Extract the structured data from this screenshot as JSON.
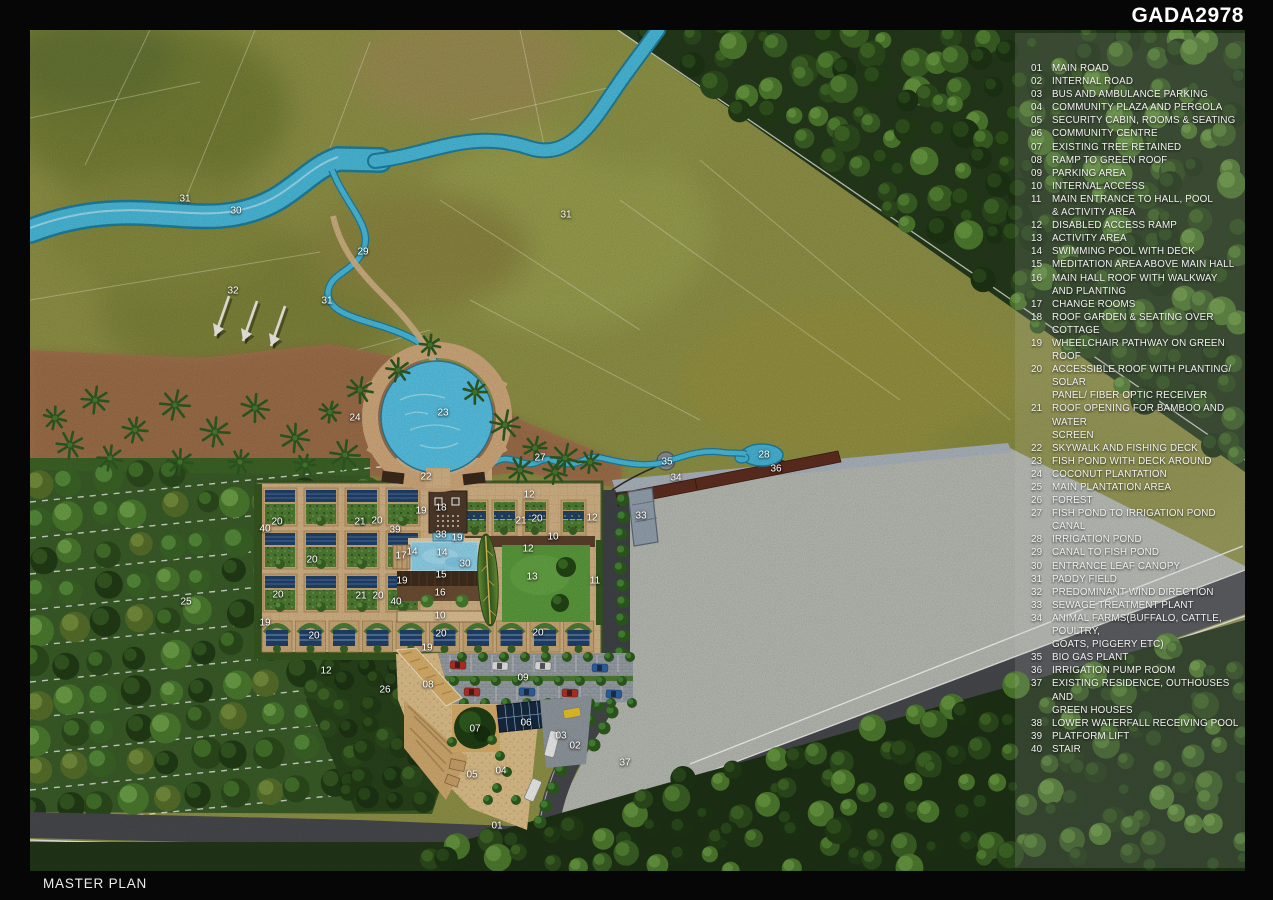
{
  "title": "GADA2978",
  "footer": "MASTER PLAN",
  "colors": {
    "frame": "#060606",
    "paddy": "#8e9146",
    "forest": "#24391b",
    "river": "#49b9d9",
    "deck_tan": "#d3b386",
    "road": "#46484c",
    "open_gray": "#b6bab2",
    "solar_panel": "#20406a",
    "lawn": "#5a9a3c",
    "pond": "#46b4d6",
    "animal_farm_strip": "#5e2d20",
    "label_text": "#ffffff"
  },
  "legend": {
    "items": [
      {
        "no": "01",
        "lines": [
          "MAIN ROAD"
        ]
      },
      {
        "no": "02",
        "lines": [
          "INTERNAL ROAD"
        ]
      },
      {
        "no": "03",
        "lines": [
          "BUS AND AMBULANCE PARKING"
        ]
      },
      {
        "no": "04",
        "lines": [
          "COMMUNITY PLAZA AND PERGOLA"
        ]
      },
      {
        "no": "05",
        "lines": [
          "SECURITY CABIN, ROOMS & SEATING"
        ]
      },
      {
        "no": "06",
        "lines": [
          "COMMUNITY CENTRE"
        ]
      },
      {
        "no": "07",
        "lines": [
          "EXISTING TREE RETAINED"
        ]
      },
      {
        "no": "08",
        "lines": [
          "RAMP TO GREEN ROOF"
        ]
      },
      {
        "no": "09",
        "lines": [
          "PARKING AREA"
        ]
      },
      {
        "no": "10",
        "lines": [
          "INTERNAL ACCESS"
        ]
      },
      {
        "no": "11",
        "lines": [
          "MAIN ENTRANCE TO HALL, POOL",
          "& ACTIVITY AREA"
        ]
      },
      {
        "no": "12",
        "lines": [
          "DISABLED ACCESS RAMP"
        ]
      },
      {
        "no": "13",
        "lines": [
          "ACTIVITY AREA"
        ]
      },
      {
        "no": "14",
        "lines": [
          "SWIMMING POOL WITH DECK"
        ]
      },
      {
        "no": "15",
        "lines": [
          "MEDITATION AREA  ABOVE MAIN HALL"
        ]
      },
      {
        "no": "16",
        "lines": [
          "MAIN HALL ROOF WITH WALKWAY",
          "AND PLANTING"
        ]
      },
      {
        "no": "17",
        "lines": [
          "CHANGE ROOMS"
        ]
      },
      {
        "no": "18",
        "lines": [
          "ROOF GARDEN & SEATING OVER COTTAGE"
        ]
      },
      {
        "no": "19",
        "lines": [
          "WHEELCHAIR PATHWAY ON GREEN ROOF"
        ]
      },
      {
        "no": "20",
        "lines": [
          "ACCESSIBLE ROOF WITH PLANTING/ SOLAR",
          "PANEL/ FIBER OPTIC RECEIVER"
        ]
      },
      {
        "no": "21",
        "lines": [
          "ROOF OPENING FOR BAMBOO AND WATER",
          "SCREEN"
        ]
      },
      {
        "no": "22",
        "lines": [
          "SKYWALK AND FISHING DECK"
        ]
      },
      {
        "no": "23",
        "lines": [
          "FISH POND WITH DECK AROUND"
        ]
      },
      {
        "no": "24",
        "lines": [
          "COCONUT PLANTATION"
        ]
      },
      {
        "no": "25",
        "lines": [
          "MAIN PLANTATION AREA"
        ]
      },
      {
        "no": "26",
        "lines": [
          "FOREST"
        ]
      },
      {
        "no": "27",
        "lines": [
          "FISH POND TO IRRIGATION POND CANAL"
        ]
      },
      {
        "no": "28",
        "lines": [
          "IRRIGATION POND"
        ]
      },
      {
        "no": "29",
        "lines": [
          "CANAL TO FISH POND"
        ]
      },
      {
        "no": "30",
        "lines": [
          "ENTRANCE LEAF CANOPY"
        ]
      },
      {
        "no": "31",
        "lines": [
          "PADDY FIELD"
        ]
      },
      {
        "no": "32",
        "lines": [
          "PREDOMINANT WIND DIRECTION"
        ]
      },
      {
        "no": "33",
        "lines": [
          "SEWAGE TREATMENT PLANT"
        ]
      },
      {
        "no": "34",
        "lines": [
          "ANIMAL FARMS(BUFFALO, CATTLE, POULTRY,",
          "GOATS, PIGGERY ETC)"
        ]
      },
      {
        "no": "35",
        "lines": [
          "BIO GAS PLANT"
        ]
      },
      {
        "no": "36",
        "lines": [
          "IRRIGATION PUMP ROOM"
        ]
      },
      {
        "no": "37",
        "lines": [
          "EXISTING RESIDENCE, OUTHOUSES AND",
          "GREEN HOUSES"
        ]
      },
      {
        "no": "38",
        "lines": [
          "LOWER WATERFALL RECEIVING POOL"
        ]
      },
      {
        "no": "39",
        "lines": [
          "PLATFORM LIFT"
        ]
      },
      {
        "no": "40",
        "lines": [
          "STAIR"
        ]
      }
    ]
  },
  "map_labels": [
    {
      "n": "31",
      "x": 185,
      "y": 199
    },
    {
      "n": "30",
      "x": 236,
      "y": 211
    },
    {
      "n": "29",
      "x": 363,
      "y": 252
    },
    {
      "n": "32",
      "x": 233,
      "y": 291
    },
    {
      "n": "31",
      "x": 327,
      "y": 301
    },
    {
      "n": "31",
      "x": 566,
      "y": 215
    },
    {
      "n": "24",
      "x": 355,
      "y": 418
    },
    {
      "n": "23",
      "x": 443,
      "y": 413
    },
    {
      "n": "22",
      "x": 426,
      "y": 477
    },
    {
      "n": "27",
      "x": 540,
      "y": 458
    },
    {
      "n": "35",
      "x": 667,
      "y": 462
    },
    {
      "n": "28",
      "x": 764,
      "y": 455
    },
    {
      "n": "36",
      "x": 776,
      "y": 469
    },
    {
      "n": "34",
      "x": 676,
      "y": 478
    },
    {
      "n": "33",
      "x": 641,
      "y": 516
    },
    {
      "n": "25",
      "x": 186,
      "y": 602
    },
    {
      "n": "26",
      "x": 385,
      "y": 690
    },
    {
      "n": "40",
      "x": 265,
      "y": 529
    },
    {
      "n": "20",
      "x": 277,
      "y": 522
    },
    {
      "n": "21",
      "x": 360,
      "y": 522
    },
    {
      "n": "20",
      "x": 377,
      "y": 521
    },
    {
      "n": "39",
      "x": 395,
      "y": 530
    },
    {
      "n": "19",
      "x": 421,
      "y": 511
    },
    {
      "n": "18",
      "x": 441,
      "y": 508
    },
    {
      "n": "12",
      "x": 529,
      "y": 495
    },
    {
      "n": "21",
      "x": 521,
      "y": 521
    },
    {
      "n": "20",
      "x": 537,
      "y": 519
    },
    {
      "n": "12",
      "x": 592,
      "y": 518
    },
    {
      "n": "10",
      "x": 553,
      "y": 537
    },
    {
      "n": "12",
      "x": 528,
      "y": 549
    },
    {
      "n": "38",
      "x": 441,
      "y": 535
    },
    {
      "n": "19",
      "x": 457,
      "y": 538
    },
    {
      "n": "14",
      "x": 412,
      "y": 552
    },
    {
      "n": "14",
      "x": 442,
      "y": 553
    },
    {
      "n": "17",
      "x": 401,
      "y": 556
    },
    {
      "n": "15",
      "x": 441,
      "y": 575
    },
    {
      "n": "19",
      "x": 402,
      "y": 581
    },
    {
      "n": "30",
      "x": 465,
      "y": 564
    },
    {
      "n": "13",
      "x": 532,
      "y": 577
    },
    {
      "n": "11",
      "x": 595,
      "y": 581
    },
    {
      "n": "16",
      "x": 440,
      "y": 593
    },
    {
      "n": "40",
      "x": 396,
      "y": 602
    },
    {
      "n": "10",
      "x": 440,
      "y": 616
    },
    {
      "n": "20",
      "x": 312,
      "y": 560
    },
    {
      "n": "20",
      "x": 278,
      "y": 595
    },
    {
      "n": "21",
      "x": 361,
      "y": 596
    },
    {
      "n": "20",
      "x": 378,
      "y": 596
    },
    {
      "n": "19",
      "x": 265,
      "y": 623
    },
    {
      "n": "12",
      "x": 326,
      "y": 671
    },
    {
      "n": "19",
      "x": 427,
      "y": 648
    },
    {
      "n": "20",
      "x": 314,
      "y": 636
    },
    {
      "n": "20",
      "x": 441,
      "y": 634
    },
    {
      "n": "20",
      "x": 538,
      "y": 633
    },
    {
      "n": "09",
      "x": 523,
      "y": 678
    },
    {
      "n": "08",
      "x": 428,
      "y": 685
    },
    {
      "n": "07",
      "x": 475,
      "y": 729
    },
    {
      "n": "06",
      "x": 526,
      "y": 723
    },
    {
      "n": "05",
      "x": 472,
      "y": 775
    },
    {
      "n": "04",
      "x": 501,
      "y": 771
    },
    {
      "n": "03",
      "x": 561,
      "y": 736
    },
    {
      "n": "02",
      "x": 575,
      "y": 746
    },
    {
      "n": "01",
      "x": 497,
      "y": 826
    },
    {
      "n": "37",
      "x": 625,
      "y": 763
    }
  ]
}
